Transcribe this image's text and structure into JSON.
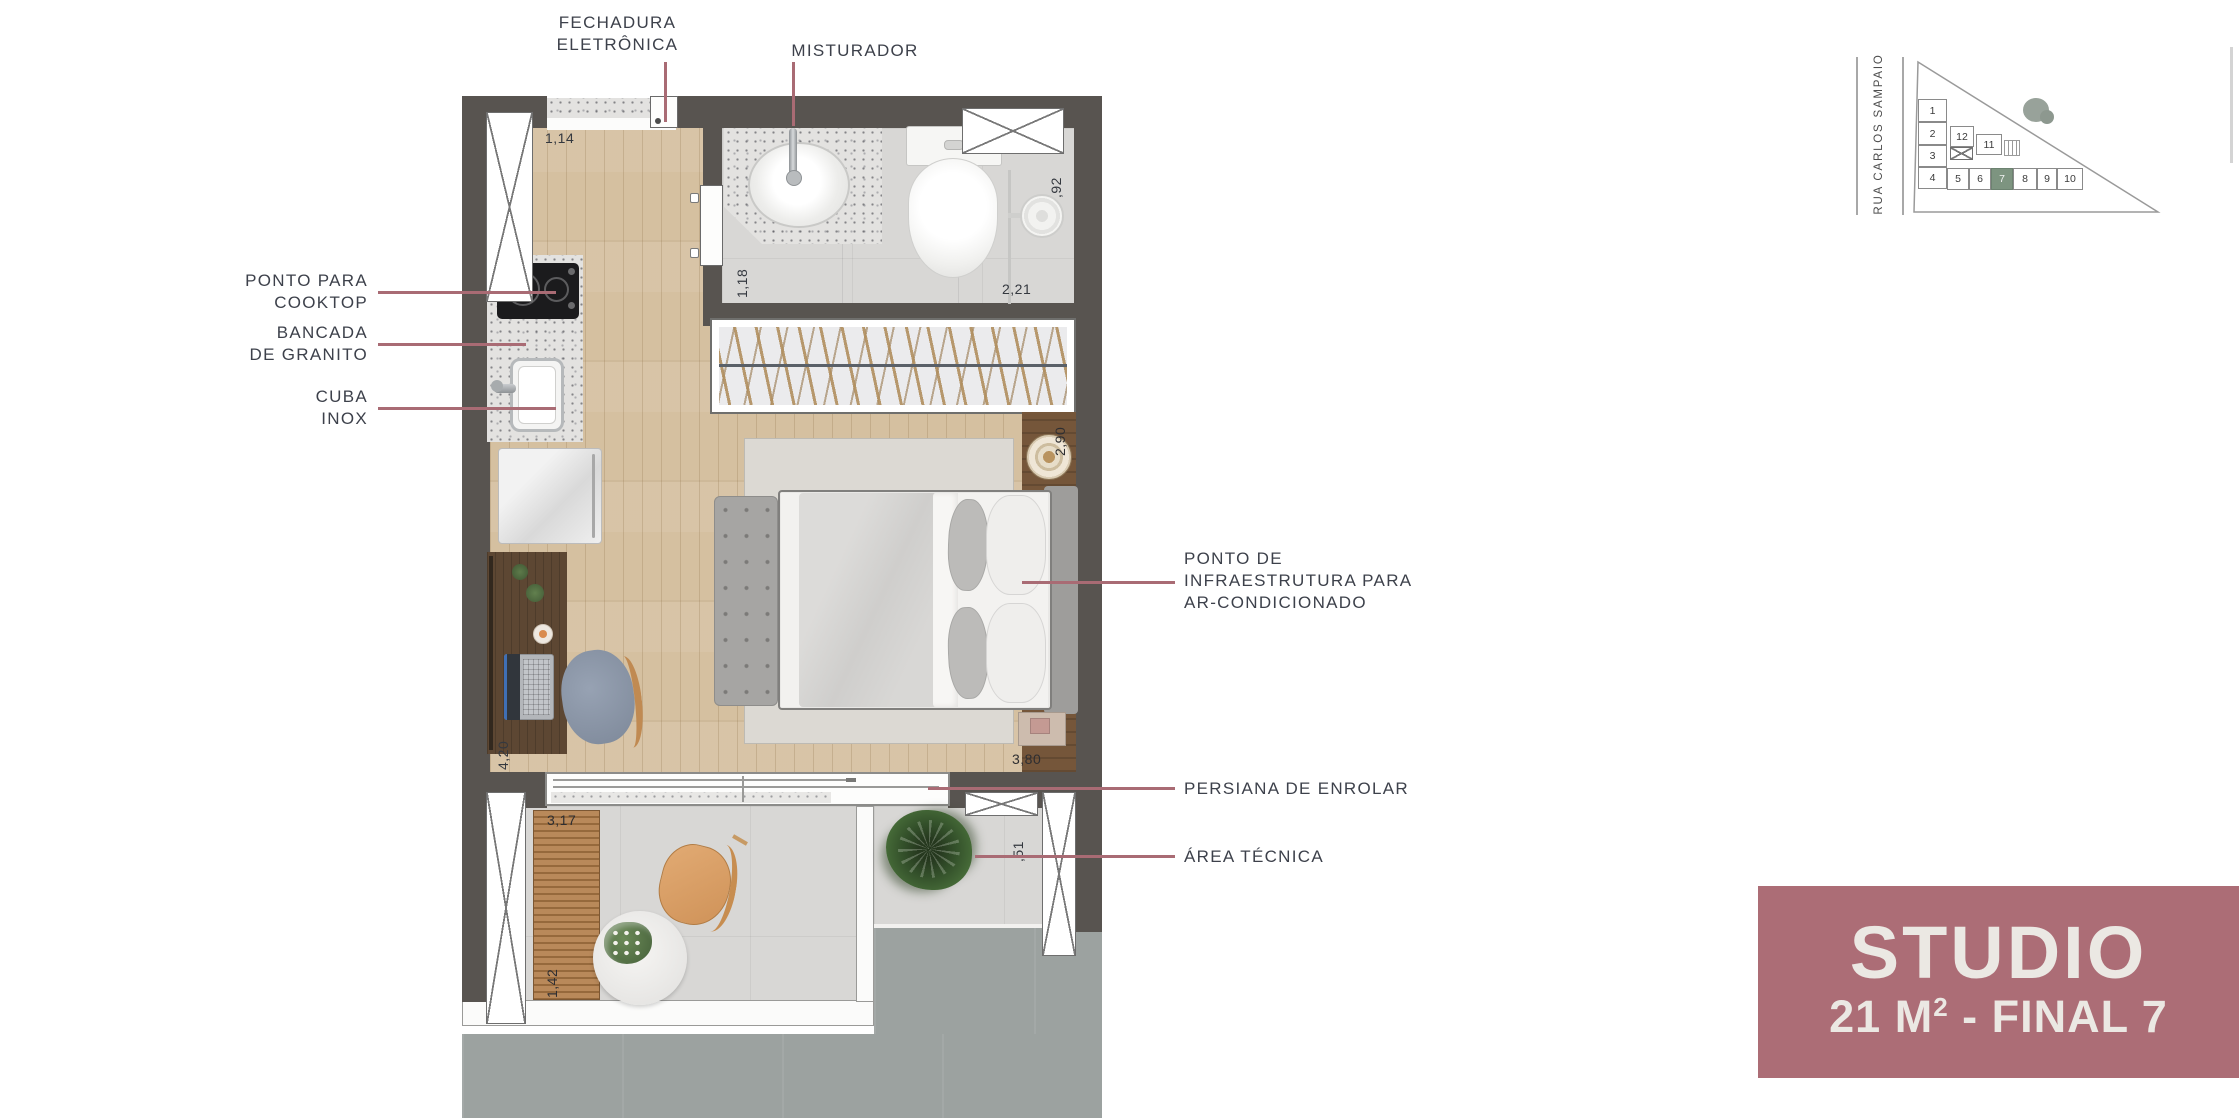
{
  "floor_plan": {
    "callouts": {
      "fechadura_line1": "FECHADURA",
      "fechadura_line2": "ELETRÔNICA",
      "misturador": "MISTURADOR",
      "cooktop_line1": "PONTO PARA",
      "cooktop_line2": "COOKTOP",
      "bancada_line1": "BANCADA",
      "bancada_line2": "DE GRANITO",
      "cuba_line1": "CUBA",
      "cuba_line2": "INOX",
      "ac_line1": "PONTO DE",
      "ac_line2": "INFRAESTRUTURA PARA",
      "ac_line3": "AR-CONDICIONADO",
      "persiana": "PERSIANA DE ENROLAR",
      "area_tecnica": "ÁREA TÉCNICA"
    },
    "dimensions": {
      "entry_hall_width": "1,14",
      "bathroom_width": "1,18",
      "bathroom_length": "2,21",
      "bathroom_recess": ",92",
      "closet_wall": "2,90",
      "bedroom_length": "3,80",
      "room_depth": "4,20",
      "balcony_width": "3,17",
      "balcony_depth": "1,42",
      "tech_area_width": ",51"
    }
  },
  "keyplan": {
    "street_name": "RUA CARLOS SAMPAIO",
    "units": [
      "1",
      "2",
      "3",
      "4",
      "5",
      "6",
      "7",
      "8",
      "9",
      "10",
      "11",
      "12"
    ],
    "highlighted_unit": "7"
  },
  "unit_banner": {
    "title": "STUDIO",
    "area_value": "21 M",
    "area_exponent": "2",
    "area_detail": " - FINAL 7"
  },
  "colors": {
    "leader_line": "#a96b74",
    "banner_bg": "#ac6d76",
    "banner_text": "#ebe8e3",
    "wall": "#585450",
    "highlighted_unit_fill": "#7d9480",
    "wood_floor": "#d5c0a0",
    "concrete_floor": "#d8d7d5",
    "exterior_slab": "#9ca2a0",
    "label_text": "#3d414b"
  }
}
